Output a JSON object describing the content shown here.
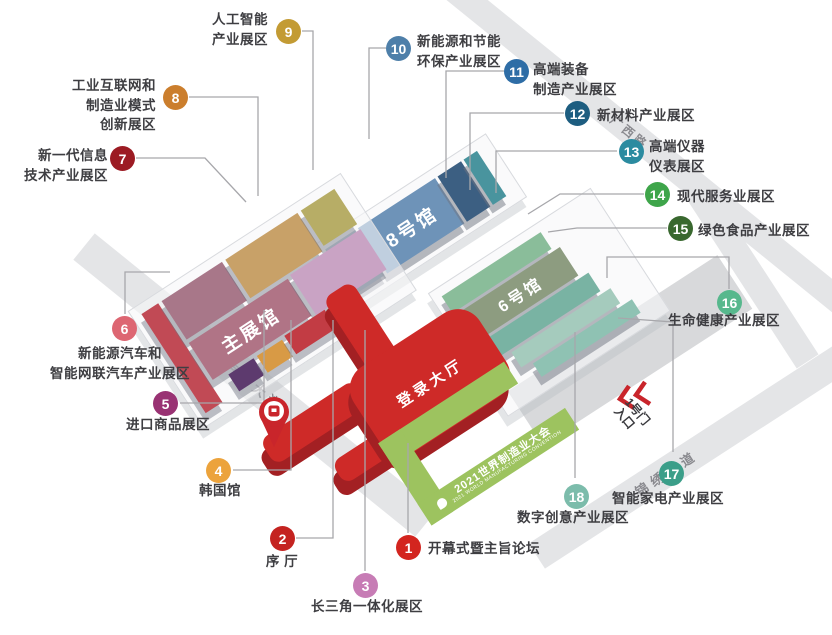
{
  "markers": [
    {
      "number": "1",
      "label": "开幕式暨主旨论坛",
      "color": "#d3251f"
    },
    {
      "number": "2",
      "label": "序 厅",
      "color": "#c42320"
    },
    {
      "number": "3",
      "label": "长三角一体化展区",
      "color": "#c77cb5"
    },
    {
      "number": "4",
      "label": "韩国馆",
      "color": "#eca33c"
    },
    {
      "number": "5",
      "label": "进口商品展区",
      "color": "#993273"
    },
    {
      "number": "6",
      "label": "新能源汽车和\n智能网联汽车产业展区",
      "color": "#dd6672"
    },
    {
      "number": "7",
      "label": "新一代信息\n技术产业展区",
      "color": "#9c1b23"
    },
    {
      "number": "8",
      "label": "工业互联网和\n制造业模式\n创新展区",
      "color": "#cb7e2d"
    },
    {
      "number": "9",
      "label": "人工智能\n产业展区",
      "color": "#c39b34"
    },
    {
      "number": "10",
      "label": "新能源和节能\n环保产业展区",
      "color": "#4e7fa9"
    },
    {
      "number": "11",
      "label": "高端装备\n制造产业展区",
      "color": "#2e6da6"
    },
    {
      "number": "12",
      "label": "新材料产业展区",
      "color": "#1d5d80"
    },
    {
      "number": "13",
      "label": "高端仪器\n仪表展区",
      "color": "#2b8ba0"
    },
    {
      "number": "14",
      "label": "现代服务业展区",
      "color": "#3ea54a"
    },
    {
      "number": "15",
      "label": "绿色食品产业展区",
      "color": "#39682f"
    },
    {
      "number": "16",
      "label": "生命健康产业展区",
      "color": "#57b88d"
    },
    {
      "number": "17",
      "label": "智能家电产业展区",
      "color": "#3b9e89"
    },
    {
      "number": "18",
      "label": "数字创意产业展区",
      "color": "#7cbcab"
    }
  ],
  "buildings": {
    "main_hall": {
      "name": "主展馆",
      "blocks": {
        "crimson": "#c14a55",
        "mauve": "#a87789",
        "gold": "#c8a168",
        "olive": "#b7ad66",
        "rose": "#b07486",
        "pink": "#c9a3c4",
        "purple": "#5d3a6e",
        "orange": "#d89a45",
        "red": "#c23c44",
        "orange_small": "#e2a64e"
      }
    },
    "hall8": {
      "name": "8号馆",
      "segments": [
        "#7e9cb6",
        "#6e93b8",
        "#3c5f82",
        "#49949e"
      ]
    },
    "hall6": {
      "name": "6号馆",
      "segments": [
        "#8abd9a",
        "#8d9c80",
        "#79b3a3",
        "#a5cbbd",
        "#8fc2b3"
      ]
    },
    "login_hall": {
      "name": "登录大厅",
      "color": "#ce2a28"
    },
    "plaza_banner": {
      "text": "2021世界制造业大会",
      "subtext": "2021 WORLD MANUFACTURING CONVENTION",
      "color": "#9dc35f"
    }
  },
  "roads": {
    "luzhou": {
      "name": "庐州大道"
    },
    "guangxi": {
      "name": "广西路"
    },
    "jinxiu": {
      "name": "锦绣大道"
    }
  },
  "gate": {
    "label": "1号门\n入口",
    "arrow_color": "#c9252b"
  },
  "pin": {
    "color": "#c9252b"
  }
}
